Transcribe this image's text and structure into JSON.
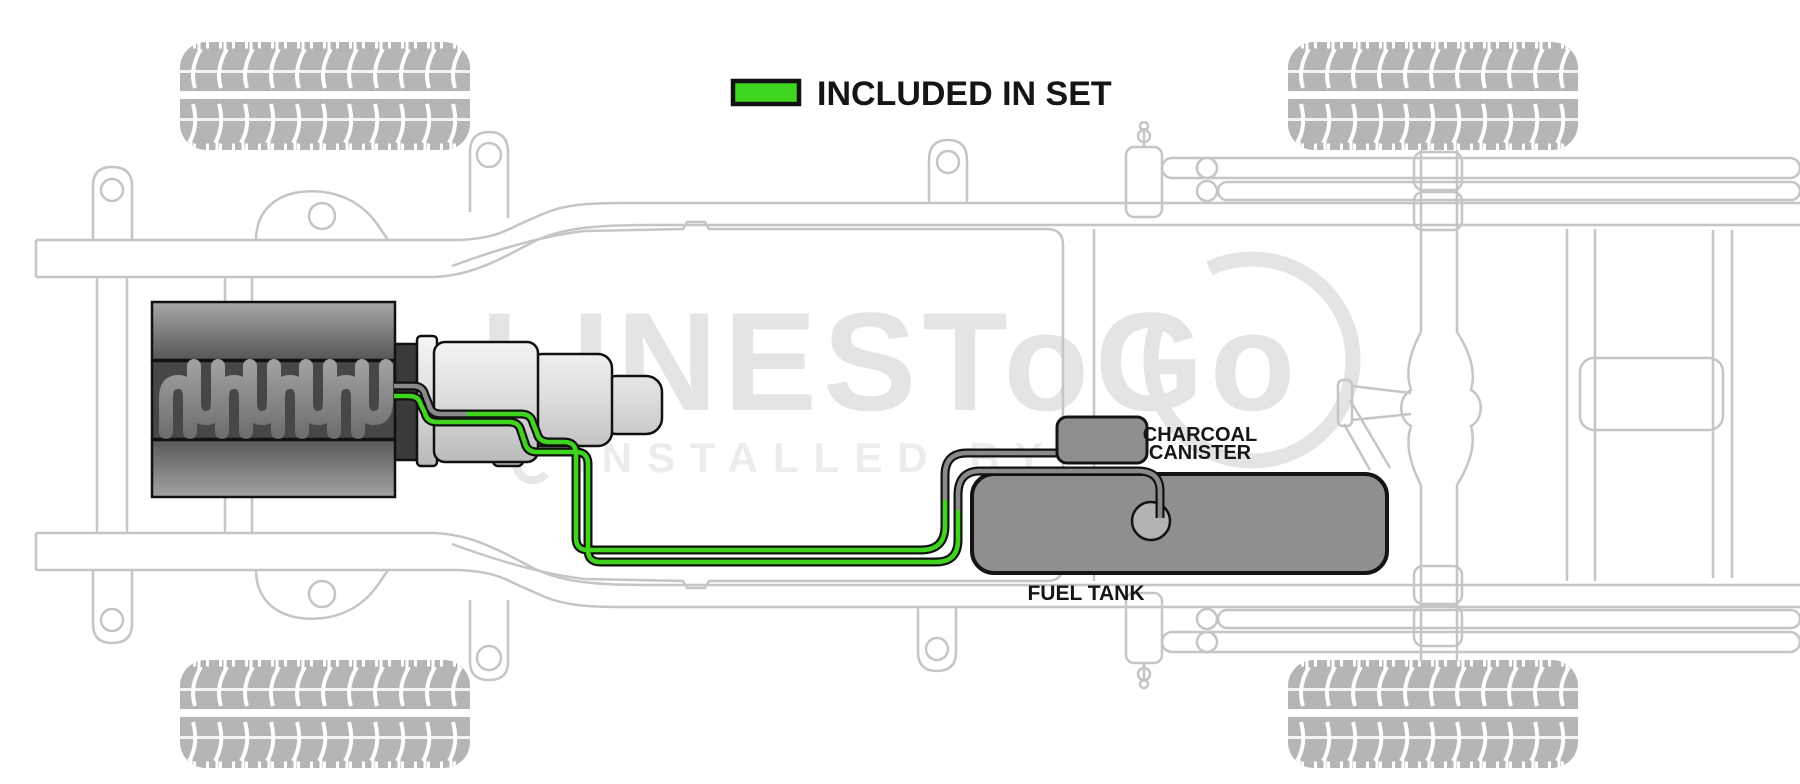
{
  "legend": {
    "label": "INCLUDED IN SET",
    "swatch_color": "#3FD41D"
  },
  "labels": {
    "charcoal_line1": "CHARCOAL",
    "charcoal_line2": "CANISTER",
    "fuel_tank": "FUEL TANK"
  },
  "watermark": {
    "brand": "LINESToGo",
    "tagline": "INSTALLED BY"
  },
  "colors": {
    "included_green": "#3FD41D",
    "not_included_gray": "#8A8A8A",
    "line_casing_black": "#111111",
    "component_gray": "#8F8F8F",
    "pump_gray": "#B3B3B3",
    "chassis_outline_gray": "#C5C5C5",
    "tire_gray": "#B5B5B5",
    "watermark_gray": "#E4E4E4"
  }
}
